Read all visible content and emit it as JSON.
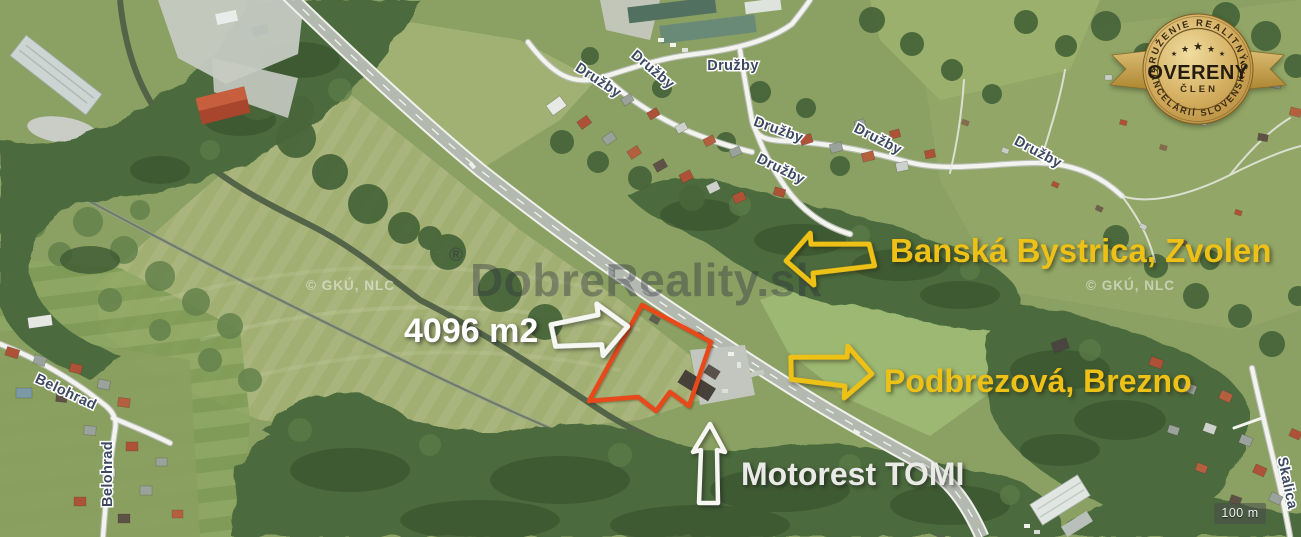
{
  "streets": {
    "druzby": "Družby",
    "belohrad": "Belohrad",
    "skalica": "Skalica"
  },
  "parcel": {
    "area_label": "4096 m2"
  },
  "directions": {
    "west": "Banská Bystrica, Zvolen",
    "east": "Podbrezová, Brezno"
  },
  "poi": {
    "motorest": "Motorest TOMI"
  },
  "badge": {
    "arc_top": "ZDRUŽENIE REALITNÝCH",
    "title": "OVERENÝ",
    "member": "ČLEN",
    "arc_bottom": "KANCELÁRIÍ SLOVENSKA",
    "star": "★"
  },
  "watermark": {
    "reg": "®",
    "brand": "DobreReality.sk",
    "source": "© GKÚ, NLC"
  },
  "scale_bar": {
    "label": "100 m"
  },
  "colors": {
    "annotation_yellow": "#eec117",
    "annotation_white": "#ffffff",
    "parcel_outline": "#e8491b",
    "street_label": "#3c4960",
    "badge_gold": "#d2ab5c",
    "field_green": "#8ba063",
    "forest_green": "#4b6a3c"
  }
}
